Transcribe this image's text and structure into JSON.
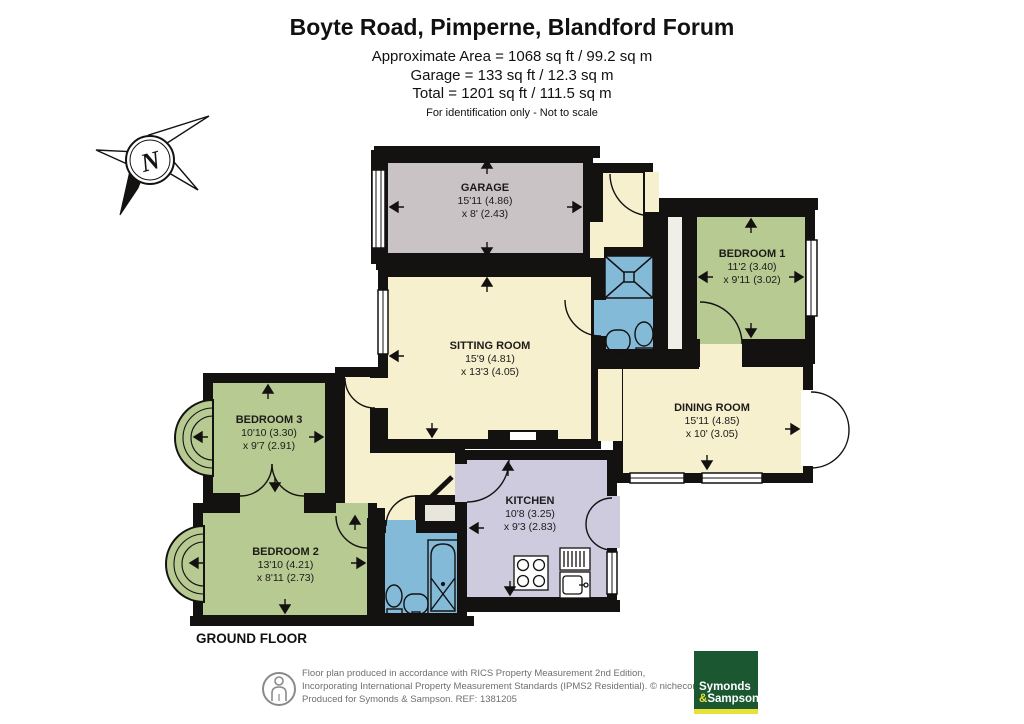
{
  "header": {
    "title": "Boyte Road, Pimperne, Blandford Forum",
    "area_line1": "Approximate Area = 1068 sq ft / 99.2 sq m",
    "area_line2": "Garage = 133 sq ft / 12.3 sq m",
    "area_line3": "Total = 1201 sq ft / 111.5 sq m",
    "disclaimer": "For identification only - Not to scale"
  },
  "compass": {
    "north_label": "N"
  },
  "rooms": {
    "garage": {
      "name": "GARAGE",
      "dim1": "15'11 (4.86)",
      "dim2": "x 8' (2.43)"
    },
    "bedroom1": {
      "name": "BEDROOM 1",
      "dim1": "11'2 (3.40)",
      "dim2": "x 9'11 (3.02)"
    },
    "sitting": {
      "name": "SITTING ROOM",
      "dim1": "15'9 (4.81)",
      "dim2": "x 13'3 (4.05)"
    },
    "dining": {
      "name": "DINING ROOM",
      "dim1": "15'11 (4.85)",
      "dim2": "x 10' (3.05)"
    },
    "bedroom3": {
      "name": "BEDROOM 3",
      "dim1": "10'10 (3.30)",
      "dim2": "x 9'7 (2.91)"
    },
    "bedroom2": {
      "name": "BEDROOM 2",
      "dim1": "13'10 (4.21)",
      "dim2": "x 8'11 (2.73)"
    },
    "kitchen": {
      "name": "KITCHEN",
      "dim1": "10'8 (3.25)",
      "dim2": "x 9'3 (2.83)"
    }
  },
  "floor_label": "GROUND FLOOR",
  "footer": {
    "line1": "Floor plan produced in accordance with RICS Property Measurement 2nd Edition,",
    "line2": "Incorporating International Property Measurement Standards (IPMS2 Residential).    © nichecom 2025.",
    "line3": "Produced for Symonds & Sampson.    REF: 1381205",
    "logo_word1": "Symonds",
    "logo_amp": "&",
    "logo_word2": "Sampson"
  },
  "colors": {
    "wall": "#141111",
    "cream": "#f7f0cf",
    "bedroom_green": "#b7ca92",
    "garage_grey": "#c9c3c6",
    "bath_blue": "#82bad8",
    "kitchen_lavender": "#cecbdf",
    "logo_green": "#1b5731",
    "logo_yellow": "#e6e23a"
  }
}
